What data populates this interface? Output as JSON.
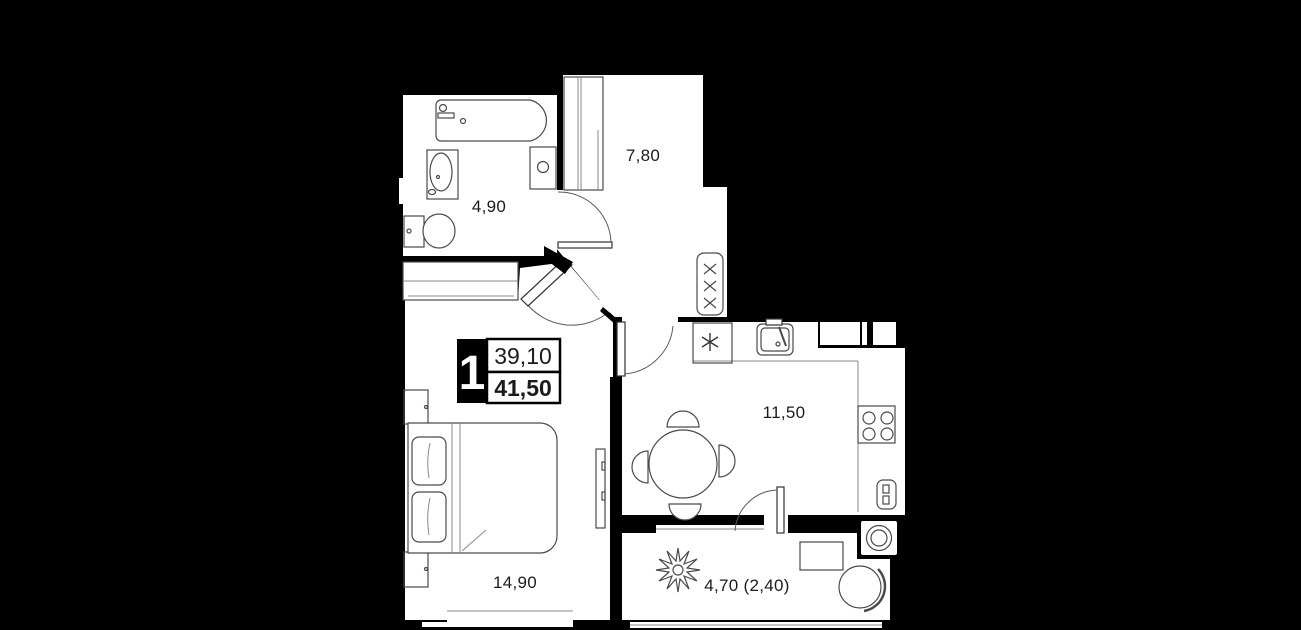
{
  "floorplan": {
    "background_color": "#000000",
    "wall_color": "#000000",
    "floor_color": "#ffffff",
    "badge": {
      "unit_number": "1",
      "living_area": "39,10",
      "total_area": "41,50"
    },
    "rooms": {
      "bathroom": {
        "area": "4,90"
      },
      "hallway": {
        "area": "7,80"
      },
      "kitchen": {
        "area": "11,50"
      },
      "bedroom": {
        "area": "14,90"
      },
      "balcony": {
        "area": "4,70 (2,40)"
      }
    },
    "fixtures": [
      "bathtub",
      "washbasin",
      "toilet",
      "bathroom-cabinet",
      "hall-wardrobe",
      "bedroom-wardrobe",
      "ventilation-grille",
      "refrigerator",
      "kitchen-sink",
      "stove",
      "kitchen-radiator",
      "dining-table",
      "dining-chairs",
      "bed",
      "nightstands",
      "tv-panel",
      "washing-machine",
      "plant",
      "balcony-table",
      "balcony-chair",
      "window",
      "door-swings"
    ]
  }
}
